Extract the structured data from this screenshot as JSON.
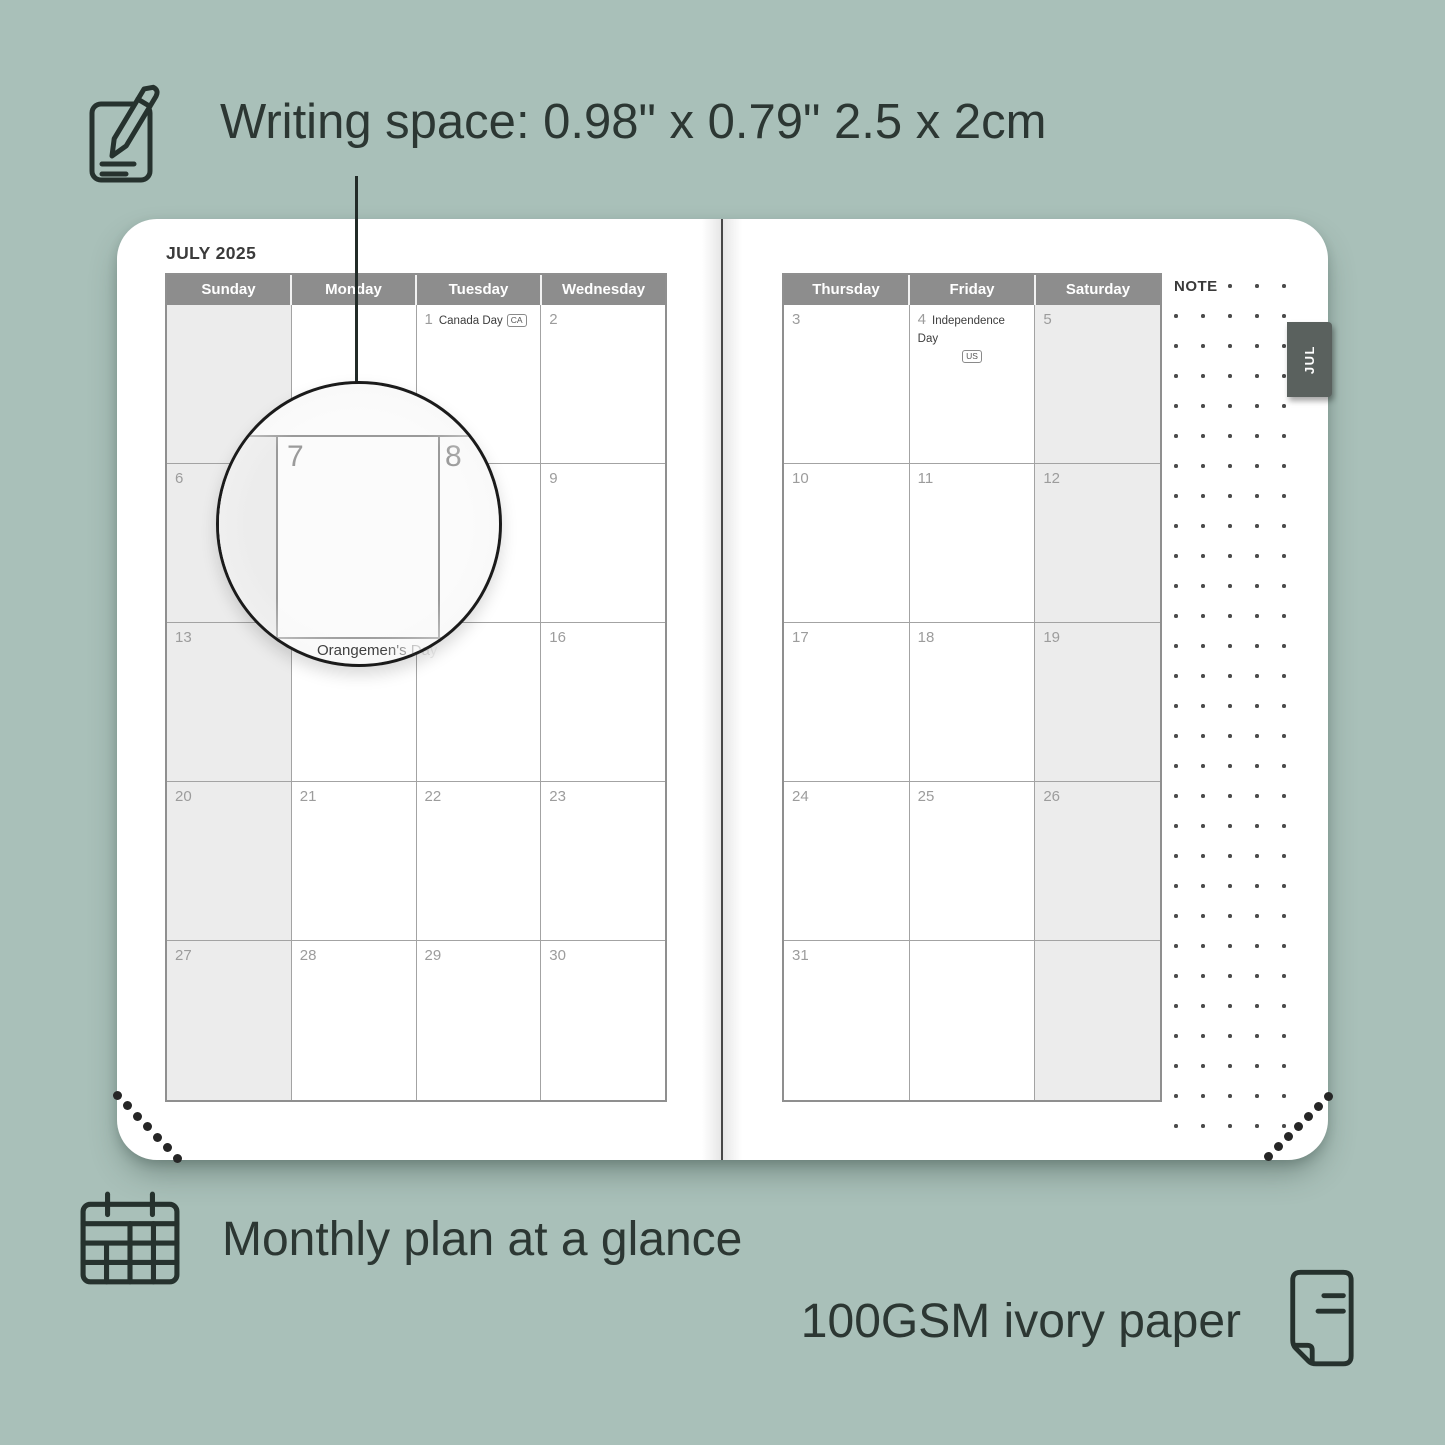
{
  "heading": {
    "text": "Writing space: 0.98\" x 0.79\" 2.5 x 2cm"
  },
  "planner": {
    "month_title": "JULY 2025",
    "note_label": "NOTE",
    "tab_label": "JUL",
    "left_page": {
      "headers": [
        "Sunday",
        "Monday",
        "Tuesday",
        "Wednesday"
      ],
      "rows": [
        [
          {},
          {},
          {
            "day": "1",
            "holiday": "Canada Day",
            "badge": "CA"
          },
          {
            "day": "2"
          }
        ],
        [
          {
            "day": "6"
          },
          {
            "day": "7"
          },
          {
            "day": "8"
          },
          {
            "day": "9"
          }
        ],
        [
          {
            "day": "13"
          },
          {
            "day": "14",
            "holiday": "Orangemen's Day",
            "overlay": true
          },
          {
            "day": "15"
          },
          {
            "day": "16"
          }
        ],
        [
          {
            "day": "20"
          },
          {
            "day": "21"
          },
          {
            "day": "22"
          },
          {
            "day": "23"
          }
        ],
        [
          {
            "day": "27"
          },
          {
            "day": "28"
          },
          {
            "day": "29"
          },
          {
            "day": "30"
          }
        ]
      ]
    },
    "right_page": {
      "headers": [
        "Thursday",
        "Friday",
        "Saturday"
      ],
      "rows": [
        [
          {
            "day": "3"
          },
          {
            "day": "4",
            "holiday": "Independence Day",
            "badge": "US",
            "badge_below": true
          },
          {
            "day": "5"
          }
        ],
        [
          {
            "day": "10"
          },
          {
            "day": "11"
          },
          {
            "day": "12"
          }
        ],
        [
          {
            "day": "17"
          },
          {
            "day": "18"
          },
          {
            "day": "19"
          }
        ],
        [
          {
            "day": "24"
          },
          {
            "day": "25"
          },
          {
            "day": "26"
          }
        ],
        [
          {
            "day": "31"
          },
          {},
          {}
        ]
      ]
    }
  },
  "magnifier": {
    "left_day": "7",
    "right_day": "8"
  },
  "callouts": {
    "monthly": "Monthly plan at a glance",
    "paper": "100GSM ivory paper"
  },
  "colors": {
    "background": "#a9c0b9",
    "ink": "#2c3733",
    "header_bg": "#8d8d8d",
    "weekend_bg": "#ececec",
    "tab_bg": "#5a615e",
    "date_number": "#9c9c9c"
  }
}
